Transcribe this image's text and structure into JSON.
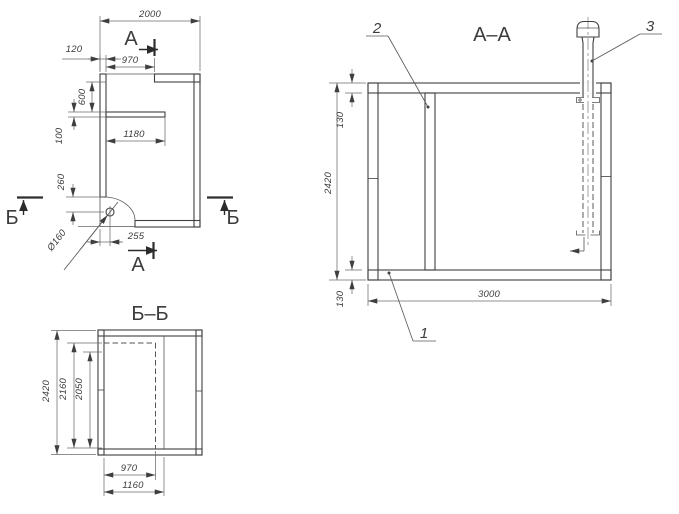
{
  "drawing_type": "technical-construction-drawing",
  "plan": {
    "section_letter_top": "А",
    "section_letter_bottom": "А",
    "section_letter_left": "Б",
    "section_letter_right": "Б",
    "dim_overall_width": "2000",
    "dim_wall_offset": "120",
    "dim_door_width": "970",
    "dim_room_depth": "600",
    "dim_partition_thickness": "100",
    "dim_partition_length": "1180",
    "dim_chimney_offset_v": "260",
    "dim_chimney_offset_h": "255",
    "dim_chimney_diameter": "Ø160"
  },
  "section_aa": {
    "title": "А–А",
    "dim_total_height": "2420",
    "dim_total_width": "3000",
    "dim_wall_top": "130",
    "dim_wall_bottom": "130",
    "callout_bottom_slab": "1",
    "callout_partition": "2",
    "callout_vent_pipe": "3"
  },
  "section_bb": {
    "title": "Б–Б",
    "dim_total_height": "2420",
    "dim_opening_height_outer": "2160",
    "dim_opening_height_inner": "2050",
    "dim_opening_width": "970",
    "dim_opening_width_outer": "1160"
  }
}
